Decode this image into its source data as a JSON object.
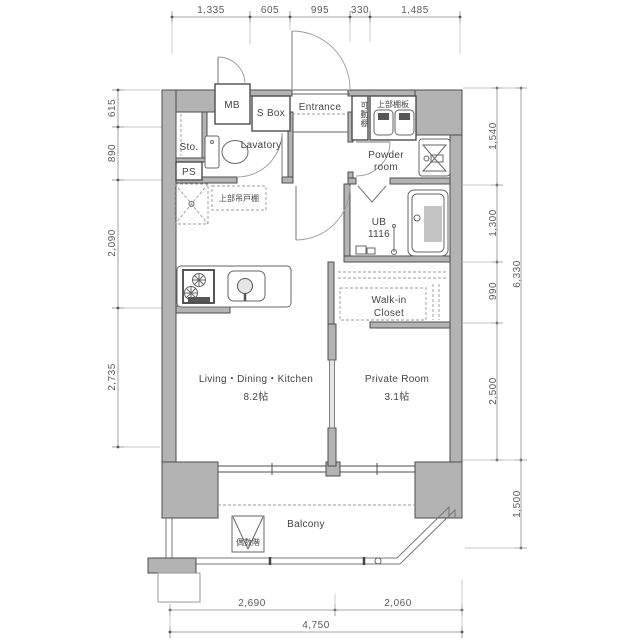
{
  "dims": {
    "top": [
      "1,335",
      "605",
      "995",
      "330",
      "1,485"
    ],
    "left": [
      "615",
      "890",
      "2,090",
      "2,735"
    ],
    "right_inner": [
      "1,540",
      "1,300",
      "990",
      "2,500"
    ],
    "right_outer": [
      "6,330",
      "1,500"
    ],
    "bottom": [
      "2,690",
      "2,060"
    ],
    "bottom_total": "4,750"
  },
  "labels": {
    "mb": "MB",
    "s_box": "S Box",
    "entrance": "Entrance",
    "movable_shelf": "可動棚",
    "upper_shelf_board": "上部棚板",
    "storage": "Sto.",
    "lavatory": "Lavatory",
    "powder_room_line1": "Powder",
    "powder_room_line2": "room",
    "pipe_shaft": "PS",
    "upper_hanging_cupboard": "上部吊戸棚",
    "unit_bath_line1": "UB",
    "unit_bath_line2": "1116",
    "walk_in_closet_line1": "Walk-in",
    "walk_in_closet_line2": "Closet",
    "ldk_line1": "Living・Dining・Kitchen",
    "ldk_line2": "8.2帖",
    "private_room_line1": "Private Room",
    "private_room_line2": "3.1帖",
    "balcony": "Balcony",
    "evacuation_hatch": "偶数階"
  },
  "colors": {
    "wall_fill": "#b3b3b3",
    "outline": "#4d4d4d",
    "dimension": "#5a5a5a",
    "text": "#3c3c3c"
  }
}
